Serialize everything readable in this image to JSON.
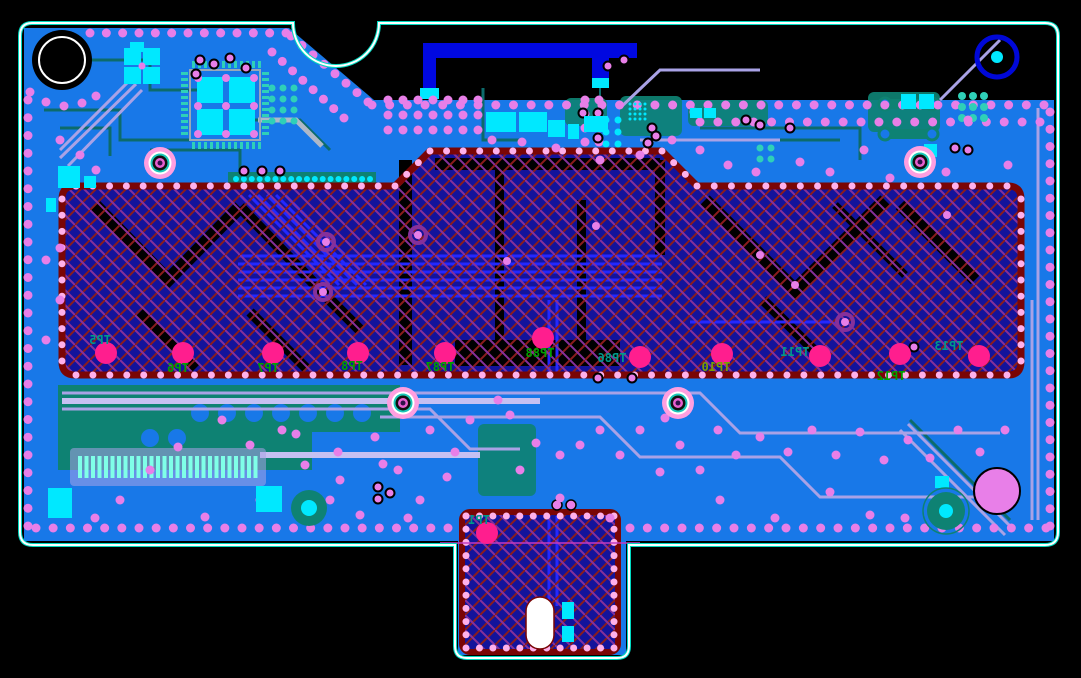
{
  "app": {
    "view_title": "PCB layout view"
  },
  "canvas": {
    "width": 1081,
    "height": 678,
    "background": "#000000"
  },
  "palette": {
    "pour_blue": "#1878e8",
    "teal": "#0e8273",
    "teal_trace": "#0c6b6b",
    "teal_pad": "#2fd0b8",
    "cyan": "#00e8ff",
    "lavender": "#a9a2e6",
    "lavender_light": "#c6c0f2",
    "violet_via": "#e87fe8",
    "border_dot": "#ffb0ea",
    "test_point": "#ff1e8e",
    "hatch_navy": "#13139b",
    "hatch_red": "#8b1c1c",
    "hatch_purple": "#86309a",
    "hatch_border": "#7a0505",
    "antenna_blue": "#0008e0",
    "outline_white": "#ffffff",
    "outline_teal": "#00d8c0",
    "label_green": "#00a000",
    "label_teal": "#00998a",
    "label_olive": "#7aa000",
    "orchid": "#e87fe8",
    "gray_trace": "#aeb8c8"
  },
  "board": {
    "outline_path": "M 32,23 H 293 A 43 43 0 0 0 379,23 H 1045 Q 1058,23 1058,36 V 532 Q 1058,545 1045,545 H 629 V 646 Q 629,658 617,658 H 467 Q 455,658 455,646 V 545 H 33 Q 20,545 20,532 V 36 Q 20,23 32,23 Z",
    "pour_path": "M 24,28 L 289,28 L 374,100 L 1054,100 L 1054,541 L 24,541 Z",
    "tab_pour": {
      "x": 458,
      "y": 541,
      "w": 168,
      "h": 114
    }
  },
  "hatch": {
    "main_path": "M 62,199 Q 62,186 75,186 L 395,186 L 430,151 L 662,151 L 697,186 L 1008,186 Q 1021,186 1021,199 L 1021,362 Q 1021,375 1008,375 L 75,375 Q 62,375 62,362 Z",
    "main_dots": [
      [
        76,
        186
      ],
      [
        395,
        186
      ],
      [
        430,
        151
      ],
      [
        662,
        151
      ],
      [
        697,
        186
      ],
      [
        1007,
        186
      ],
      [
        1021,
        199
      ],
      [
        1021,
        361
      ],
      [
        1007,
        375
      ],
      [
        76,
        375
      ],
      [
        62,
        361
      ],
      [
        62,
        199
      ],
      [
        76,
        186
      ]
    ],
    "black_bands": [
      {
        "d": "M 95,205 L 168,280 L 240,207",
        "w": 13
      },
      {
        "d": "M 240,207 L 330,300 L 360,330",
        "w": 11
      },
      {
        "d": "M 140,312 L 196,368",
        "w": 10
      },
      {
        "d": "M 250,312 L 306,368",
        "w": 10
      },
      {
        "d": "M 705,200 L 795,290 L 885,200",
        "w": 13
      },
      {
        "d": "M 900,205 L 975,280",
        "w": 12
      },
      {
        "d": "M 763,300 L 822,358",
        "w": 10
      },
      {
        "d": "M 835,205 L 905,275",
        "w": 8
      }
    ],
    "black_rects": [
      [
        399,
        160,
        13,
        205
      ],
      [
        495,
        160,
        9,
        205
      ],
      [
        577,
        200,
        9,
        140
      ],
      [
        655,
        160,
        10,
        95
      ],
      [
        455,
        340,
        165,
        26
      ],
      [
        435,
        158,
        225,
        12
      ]
    ],
    "blue_bus": {
      "x1": 238,
      "x2": 662,
      "y0": 256,
      "dy": 8,
      "n": 6
    },
    "blue_diagonals": {
      "x0": 240,
      "y0": 195,
      "dx": 9,
      "len": 90,
      "n": 6
    },
    "blue_extra": [
      "M 549,300 V 375",
      "M 557,300 V 375",
      "M 690,322 H 838"
    ],
    "ring_vias": [
      [
        326,
        242
      ],
      [
        323,
        292
      ],
      [
        418,
        235
      ],
      [
        845,
        322
      ]
    ],
    "plain_vias": [
      [
        507,
        261
      ],
      [
        795,
        285
      ],
      [
        947,
        215
      ],
      [
        596,
        226
      ],
      [
        760,
        255
      ]
    ]
  },
  "tab": {
    "x": 462,
    "y": 512,
    "w": 156,
    "h": 140,
    "dots": [
      [
        466,
        516
      ],
      [
        614,
        516
      ],
      [
        614,
        648
      ],
      [
        466,
        648
      ],
      [
        466,
        516
      ]
    ],
    "pill": {
      "x": 526,
      "y": 597,
      "w": 28,
      "h": 52
    },
    "cyan_pads": [
      [
        562,
        602,
        12,
        17
      ],
      [
        562,
        626,
        12,
        16
      ]
    ],
    "blue_traces": [
      "M 549,516 V 600",
      "M 557,516 V 606"
    ],
    "purple_line": {
      "x1": 440,
      "x2": 640,
      "y": 543
    },
    "ring_vias": [
      [
        557,
        505
      ],
      [
        571,
        505
      ]
    ]
  },
  "antenna": {
    "bars": [
      [
        423,
        43,
        214,
        15
      ],
      [
        423,
        43,
        13,
        52
      ],
      [
        592,
        43,
        17,
        42
      ]
    ],
    "pads": [
      [
        420,
        88,
        19,
        11
      ],
      [
        592,
        78,
        17,
        10
      ]
    ],
    "feed_trace": "M 600,88 V 112"
  },
  "holes": {
    "black_hole": {
      "cx": 62,
      "cy": 60,
      "r_outer": 30,
      "r_ring": 23
    },
    "blue_ring": {
      "cx": 997,
      "cy": 57,
      "r": 20,
      "center_r": 6
    },
    "orchid_circle": {
      "cx": 997,
      "cy": 491,
      "r": 23
    },
    "teal_circle_br": {
      "cx": 946,
      "cy": 511,
      "r": 19,
      "center_r": 7
    },
    "teal_circle_bl": {
      "cx": 309,
      "cy": 508,
      "r": 18,
      "center_r": 8
    }
  },
  "mount_vias": [
    [
      160,
      163
    ],
    [
      920,
      162
    ],
    [
      403,
      403
    ],
    [
      678,
      403
    ]
  ],
  "test_points": [
    {
      "id": "TP5",
      "x": 106,
      "y": 353,
      "lx": 100,
      "ly": 344,
      "lc": "label_teal"
    },
    {
      "id": "TP6",
      "x": 183,
      "y": 353,
      "lx": 178,
      "ly": 372,
      "lc": "label_green"
    },
    {
      "id": "TP7",
      "x": 273,
      "y": 353,
      "lx": 268,
      "ly": 372,
      "lc": "label_green"
    },
    {
      "id": "TP8",
      "x": 358,
      "y": 353,
      "lx": 352,
      "ly": 370,
      "lc": "label_green"
    },
    {
      "id": "TP87",
      "x": 445,
      "y": 353,
      "lx": 440,
      "ly": 371,
      "lc": "label_green"
    },
    {
      "id": "TP88",
      "x": 543,
      "y": 338,
      "lx": 540,
      "ly": 357,
      "lc": "label_green"
    },
    {
      "id": "TP86",
      "x": 640,
      "y": 357,
      "lx": 612,
      "ly": 362,
      "lc": "label_teal"
    },
    {
      "id": "TP10",
      "x": 722,
      "y": 354,
      "lx": 716,
      "ly": 371,
      "lc": "label_olive"
    },
    {
      "id": "TP11",
      "x": 820,
      "y": 356,
      "lx": 795,
      "ly": 356,
      "lc": "label_teal"
    },
    {
      "id": "TP12",
      "x": 900,
      "y": 354,
      "lx": 891,
      "ly": 380,
      "lc": "label_green"
    },
    {
      "id": "TP13",
      "x": 979,
      "y": 356,
      "lx": 949,
      "ly": 350,
      "lc": "label_teal"
    },
    {
      "id": "TP1",
      "x": 487,
      "y": 533,
      "lx": 479,
      "ly": 524,
      "lc": "label_teal"
    }
  ],
  "dot_rows": [
    {
      "pts": [
        [
          372,
          105
        ],
        [
          1044,
          105
        ]
      ],
      "sp": 17.5,
      "r": 4.5,
      "c": "violet_via"
    },
    {
      "pts": [
        [
          700,
          122
        ],
        [
          1040,
          122
        ]
      ],
      "sp": 17.5,
      "r": 4.5,
      "c": "violet_via"
    },
    {
      "pts": [
        [
          90,
          33
        ],
        [
          286,
          33
        ]
      ],
      "sp": 17,
      "r": 4.5,
      "c": "violet_via"
    },
    {
      "pts": [
        [
          291,
          36
        ],
        [
          368,
          102
        ]
      ],
      "sp": 15,
      "r": 4.5,
      "c": "violet_via"
    },
    {
      "pts": [
        [
          272,
          52
        ],
        [
          344,
          118
        ]
      ],
      "sp": 15,
      "r": 4.5,
      "c": "violet_via"
    },
    {
      "pts": [
        [
          28,
          100
        ],
        [
          28,
          526
        ]
      ],
      "sp": 17.5,
      "r": 4.5,
      "c": "violet_via"
    },
    {
      "pts": [
        [
          1050,
          112
        ],
        [
          1050,
          526
        ]
      ],
      "sp": 17.5,
      "r": 4.5,
      "c": "violet_via"
    },
    {
      "pts": [
        [
          36,
          528
        ],
        [
          448,
          528
        ]
      ],
      "sp": 17.5,
      "r": 4.5,
      "c": "violet_via"
    },
    {
      "pts": [
        [
          630,
          528
        ],
        [
          1046,
          528
        ]
      ],
      "sp": 17.5,
      "r": 4.5,
      "c": "violet_via"
    },
    {
      "pts": [
        [
          30,
          92
        ],
        [
          46,
          102
        ],
        [
          64,
          106
        ],
        [
          82,
          103
        ],
        [
          96,
          96
        ]
      ],
      "sp": 16,
      "r": 4.5,
      "c": "violet_via"
    },
    {
      "pts": [
        [
          236,
          179
        ],
        [
          370,
          179
        ]
      ],
      "sp": 8,
      "r": 3,
      "c": "cyan"
    }
  ],
  "via_grids": [
    {
      "x": 388,
      "y": 100,
      "cols": 7,
      "rows": 3,
      "step": 15,
      "r": 4.5,
      "c": "violet_via"
    },
    {
      "x": 585,
      "y": 100,
      "cols": 2,
      "rows": 4,
      "step": 14,
      "r": 4.5,
      "c": "violet_via"
    }
  ],
  "pad_grids": [
    {
      "x": 272,
      "y": 88,
      "cols": 3,
      "rows": 4,
      "step": 11,
      "r": 3.5,
      "c": "teal_pad"
    },
    {
      "x": 962,
      "y": 96,
      "cols": 3,
      "rows": 3,
      "step": 11,
      "r": 4,
      "c": "teal_pad"
    },
    {
      "x": 606,
      "y": 120,
      "cols": 2,
      "rows": 3,
      "step": 12,
      "r": 3.5,
      "c": "cyan"
    },
    {
      "x": 760,
      "y": 148,
      "cols": 2,
      "rows": 2,
      "step": 11,
      "r": 3.5,
      "c": "teal_pad"
    },
    {
      "x": 630,
      "y": 104,
      "cols": 4,
      "rows": 4,
      "step": 5,
      "r": 1.5,
      "c": "cyan"
    }
  ],
  "scatter_vias": [
    [
      282,
      430
    ],
    [
      296,
      434
    ],
    [
      338,
      452
    ],
    [
      375,
      437
    ],
    [
      383,
      464
    ],
    [
      398,
      470
    ],
    [
      447,
      477
    ],
    [
      470,
      420
    ],
    [
      498,
      400
    ],
    [
      510,
      415
    ],
    [
      536,
      443
    ],
    [
      560,
      455
    ],
    [
      580,
      445
    ],
    [
      600,
      430
    ],
    [
      620,
      455
    ],
    [
      640,
      430
    ],
    [
      665,
      418
    ],
    [
      680,
      445
    ],
    [
      700,
      470
    ],
    [
      718,
      430
    ],
    [
      736,
      455
    ],
    [
      760,
      437
    ],
    [
      788,
      452
    ],
    [
      812,
      430
    ],
    [
      836,
      455
    ],
    [
      860,
      432
    ],
    [
      884,
      460
    ],
    [
      908,
      440
    ],
    [
      930,
      458
    ],
    [
      958,
      430
    ],
    [
      980,
      452
    ],
    [
      1005,
      430
    ],
    [
      340,
      480
    ],
    [
      420,
      500
    ],
    [
      520,
      470
    ],
    [
      560,
      498
    ],
    [
      610,
      518
    ],
    [
      660,
      472
    ],
    [
      720,
      500
    ],
    [
      775,
      518
    ],
    [
      830,
      492
    ],
    [
      870,
      515
    ],
    [
      905,
      518
    ],
    [
      260,
      500
    ],
    [
      205,
      517
    ],
    [
      120,
      500
    ],
    [
      95,
      518
    ],
    [
      150,
      470
    ],
    [
      178,
      447
    ],
    [
      222,
      420
    ],
    [
      250,
      445
    ],
    [
      430,
      430
    ],
    [
      455,
      452
    ],
    [
      305,
      465
    ],
    [
      330,
      500
    ],
    [
      360,
      515
    ],
    [
      408,
      518
    ],
    [
      600,
      160
    ],
    [
      640,
      155
    ],
    [
      672,
      140
    ],
    [
      700,
      150
    ],
    [
      728,
      165
    ],
    [
      756,
      172
    ],
    [
      800,
      162
    ],
    [
      830,
      172
    ],
    [
      864,
      150
    ],
    [
      890,
      178
    ],
    [
      946,
      172
    ],
    [
      968,
      120
    ],
    [
      1008,
      165
    ],
    [
      60,
      140
    ],
    [
      80,
      155
    ],
    [
      96,
      170
    ],
    [
      60,
      248
    ],
    [
      60,
      300
    ],
    [
      46,
      340
    ],
    [
      46,
      260
    ],
    [
      492,
      140
    ],
    [
      522,
      142
    ],
    [
      556,
      148
    ],
    [
      694,
      112
    ]
  ],
  "ring_vias": [
    [
      200,
      60
    ],
    [
      214,
      64
    ],
    [
      230,
      58
    ],
    [
      196,
      74
    ],
    [
      246,
      68
    ],
    [
      583,
      113
    ],
    [
      598,
      113
    ],
    [
      598,
      138
    ],
    [
      652,
      128
    ],
    [
      656,
      136
    ],
    [
      648,
      143
    ],
    [
      746,
      120
    ],
    [
      760,
      125
    ],
    [
      790,
      128
    ],
    [
      955,
      148
    ],
    [
      968,
      150
    ],
    [
      608,
      66
    ],
    [
      624,
      60
    ],
    [
      598,
      378
    ],
    [
      632,
      378
    ],
    [
      378,
      487
    ],
    [
      378,
      499
    ],
    [
      390,
      493
    ],
    [
      244,
      171
    ],
    [
      262,
      171
    ],
    [
      280,
      171
    ],
    [
      914,
      347
    ]
  ],
  "cyan_rects": [
    [
      48,
      488,
      24,
      30
    ],
    [
      256,
      486,
      26,
      26
    ],
    [
      486,
      112,
      30,
      20
    ],
    [
      519,
      112,
      28,
      20
    ],
    [
      548,
      120,
      17,
      17
    ],
    [
      568,
      124,
      11,
      15
    ],
    [
      584,
      116,
      24,
      16
    ],
    [
      901,
      94,
      15,
      15
    ],
    [
      919,
      94,
      15,
      15
    ],
    [
      924,
      144,
      13,
      13
    ],
    [
      58,
      166,
      22,
      22
    ],
    [
      84,
      176,
      12,
      12
    ],
    [
      46,
      198,
      10,
      14
    ],
    [
      690,
      108,
      12,
      10
    ],
    [
      704,
      108,
      12,
      10
    ],
    [
      935,
      476,
      14,
      12
    ],
    [
      130,
      42,
      14,
      10
    ]
  ],
  "teal_shapes": {
    "blob_poly": "58,385 400,385 400,432 312,432 312,470 58,470",
    "band": [
      228,
      172,
      148,
      13
    ],
    "patches": [
      [
        565,
        98,
        42,
        28
      ],
      [
        620,
        96,
        62,
        40
      ],
      [
        688,
        100,
        80,
        26
      ],
      [
        868,
        92,
        72,
        40
      ],
      [
        478,
        424,
        58,
        72
      ],
      [
        150,
        388,
        120,
        26
      ]
    ],
    "clearance_circles": [
      [
        200,
        413
      ],
      [
        227,
        413
      ],
      [
        254,
        413
      ],
      [
        281,
        413
      ],
      [
        308,
        413
      ],
      [
        335,
        413
      ],
      [
        362,
        413
      ],
      [
        150,
        438
      ],
      [
        177,
        438
      ]
    ]
  },
  "connector": {
    "bg": [
      70,
      448,
      196,
      38
    ],
    "x0": 78,
    "y0": 456,
    "n": 28,
    "step": 6.5,
    "bw": 4,
    "bh": 22
  },
  "qfp": {
    "frame": [
      190,
      70,
      70,
      70
    ],
    "squares": [
      [
        197,
        77,
        26,
        26
      ],
      [
        229,
        77,
        26,
        26
      ],
      [
        197,
        109,
        26,
        26
      ],
      [
        229,
        109,
        26,
        26
      ]
    ],
    "dot_grid": {
      "x": 198,
      "y": 78,
      "cols": 3,
      "rows": 3,
      "step": 28,
      "r": 4,
      "c": "violet_via"
    },
    "pin_rows": {
      "top_y": 61,
      "bot_y": 142,
      "x0": 192,
      "n": 12,
      "step": 6
    },
    "pin_cols": {
      "left_x": 181,
      "right_x": 262,
      "y0": 72,
      "n": 11,
      "step": 6
    }
  },
  "quad_component": {
    "squares": [
      [
        124,
        48,
        17,
        17
      ],
      [
        143,
        48,
        17,
        17
      ],
      [
        124,
        67,
        17,
        17
      ],
      [
        143,
        67,
        17,
        17
      ]
    ],
    "center_via": [
      142,
      66
    ]
  },
  "dogbones": [
    {
      "d": "M 886,104 H 930",
      "ends": [
        [
          885,
          104
        ],
        [
          932,
          104
        ]
      ]
    },
    {
      "d": "M 886,134 H 930",
      "ends": [
        [
          885,
          134
        ],
        [
          932,
          134
        ]
      ]
    }
  ],
  "traces": {
    "lavender": [
      "M 62,393 H 700 L 740,433 H 1000",
      "M 62,409 H 430 L 470,449 H 520",
      "M 380,417 H 600 L 640,457 H 780 L 820,497 H 1000",
      "M 60,150 L 130,80",
      "M 60,158 L 136,84",
      "M 68,166 L 142,90",
      "M 940,100 L 1000,40",
      "M 900,430 L 1005,535",
      "M 908,424 L 1012,528",
      "M 1038,108 V 520",
      "M 1032,300 V 520",
      "M 640,140 H 780",
      "M 620,108 L 660,70 H 760"
    ],
    "lavender_wide": [
      "M 62,401 H 540",
      "M 260,455 H 480"
    ],
    "teal": [
      "M 40,60 H 150 V 90 H 220",
      "M 44,110 H 120 V 140 H 190",
      "M 60,128 H 110 V 156",
      "M 240,120 H 300 L 330,150",
      "M 150,150 H 240 V 170",
      "M 910,420 L 1010,520",
      "M 700,128 H 860 V 160",
      "M 720,140 H 840",
      "M 483,88 V 140 H 520"
    ],
    "gray": [
      "M 258,120 H 296 L 322,146"
    ]
  },
  "labels_note": "All TP text is mirrored (bottom-layer silkscreen)"
}
